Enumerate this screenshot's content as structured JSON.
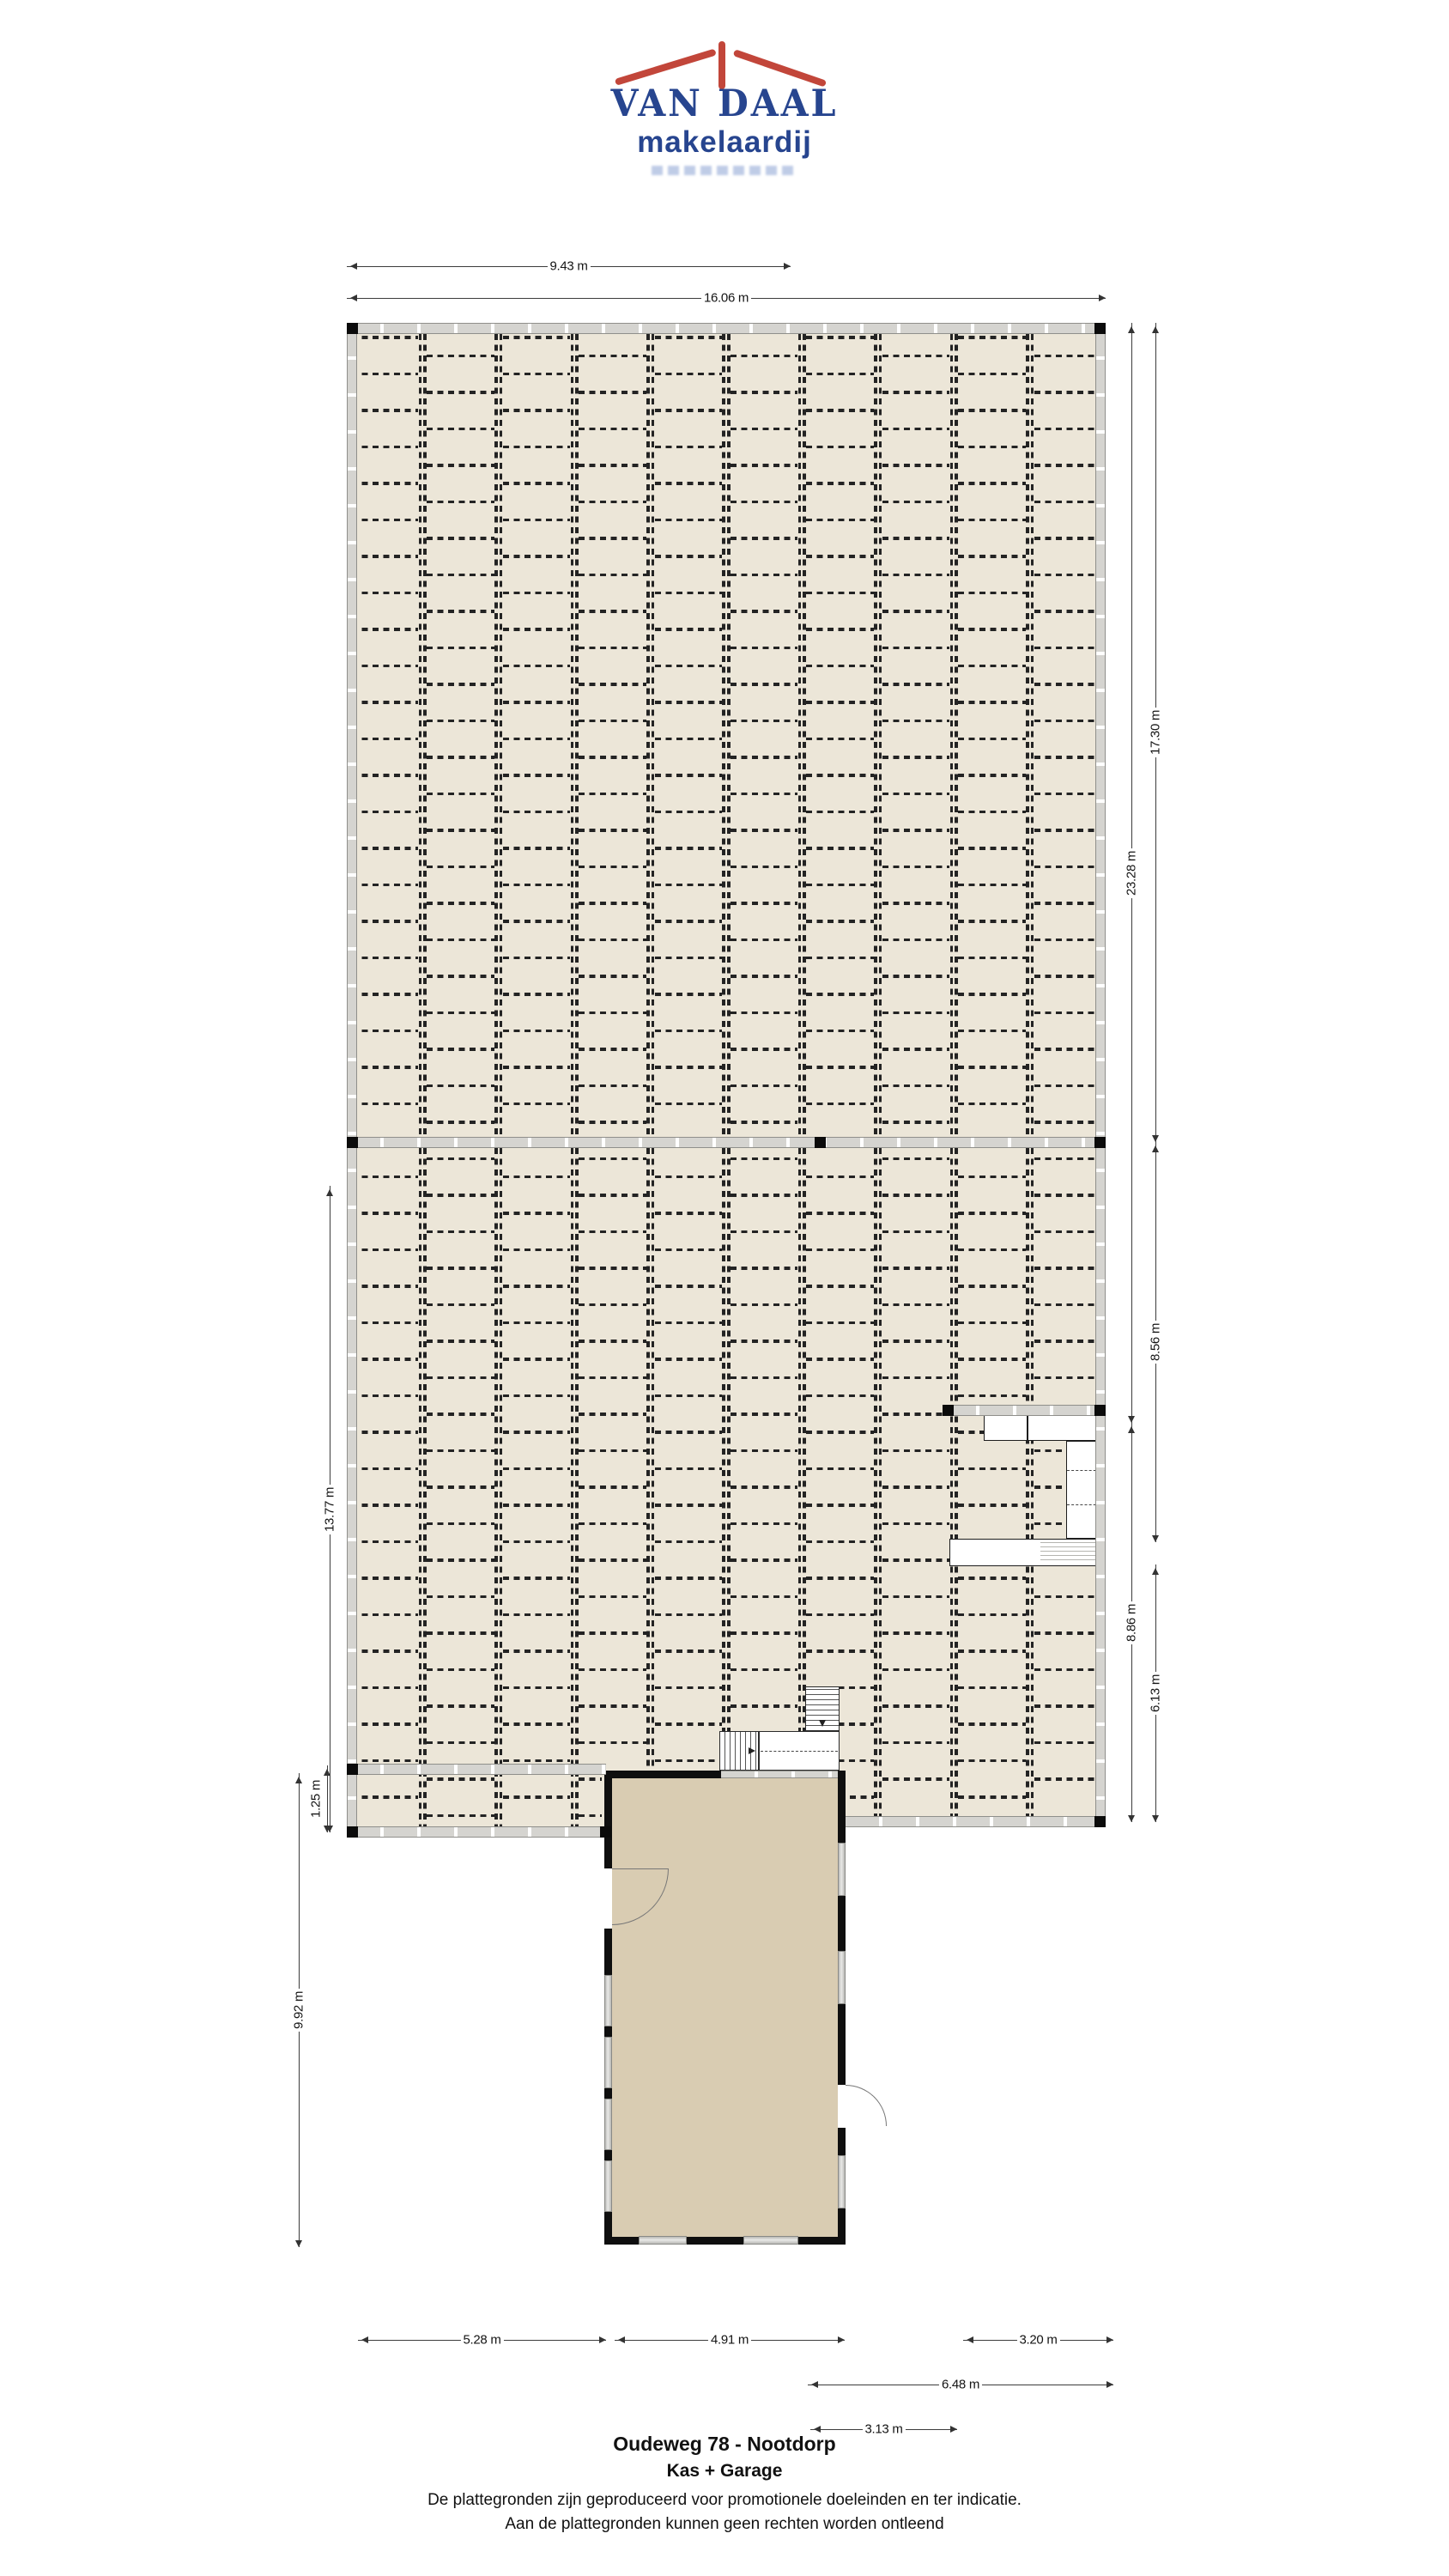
{
  "logo": {
    "title": "VAN DAAL",
    "subtitle": "makelaardij"
  },
  "labels": {
    "pool": "Zwembad",
    "garage": "Garage",
    "garage_height": "H = 4.23m"
  },
  "dimensions": {
    "top": [
      "9.43 m",
      "16.06 m"
    ],
    "right_inner": [
      "17.30 m",
      "8.56 m",
      "6.13 m"
    ],
    "right_outer": [
      "23.28 m",
      "8.86 m"
    ],
    "left": [
      "13.77 m",
      "1.25 m",
      "9.92 m"
    ],
    "bottom": [
      "5.28 m",
      "4.91 m",
      "3.20 m",
      "6.48 m",
      "3.13 m"
    ]
  },
  "footer": {
    "title": "Oudeweg 78 - Nootdorp",
    "subtitle": "Kas + Garage",
    "disclaimer1": "De plattegronden zijn geproduceerd voor promotionele doeleinden en ter indicatie.",
    "disclaimer2": "Aan de plattegronden kunnen geen rechten worden ontleend"
  },
  "colors": {
    "logo_red": "#c2463a",
    "logo_blue": "#27458f",
    "cell_fill": "#ece6d8",
    "dash": "#232323",
    "glass_wall": "#d5d4d0",
    "pool_fill": "rgba(100,150,186,0.5)",
    "pool_border": "#35576e",
    "garage_fill": "#d9ccb2",
    "wall_black": "#0f0f0f"
  }
}
